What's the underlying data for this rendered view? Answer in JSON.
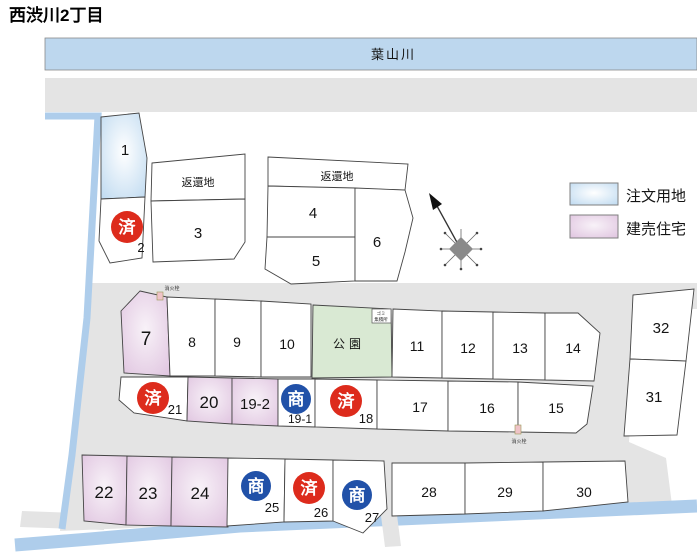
{
  "title": "西渋川2丁目",
  "river": {
    "label": "葉山川"
  },
  "legend": {
    "order_land": {
      "label": "注文用地",
      "fill": "#BDD9F0"
    },
    "built_house": {
      "label": "建売住宅",
      "fill": "#DFC3DF"
    }
  },
  "annotations": {
    "returned_land": "返還地",
    "park": "公園",
    "fire_hydrant": "消火栓",
    "garbage_line1": "ゴミ",
    "garbage_line2": "集積所"
  },
  "badges": {
    "sold": "済",
    "dealing": "商"
  },
  "colors": {
    "sold_badge": "#DD2B1C",
    "dealing_badge": "#2151A8",
    "water": "#AECDEB",
    "river_fill": "#BDD7EE",
    "road": "#E4E4E4",
    "park_fill": "#D9E9D3"
  },
  "lots": {
    "l1": {
      "number": "1",
      "type": "order_land"
    },
    "l2": {
      "number": "2",
      "badge": "済"
    },
    "l3": {
      "number": "3"
    },
    "l4": {
      "number": "4"
    },
    "l5": {
      "number": "5"
    },
    "l6": {
      "number": "6"
    },
    "l7": {
      "number": "7",
      "type": "built_house"
    },
    "l8": {
      "number": "8"
    },
    "l9": {
      "number": "9"
    },
    "l10": {
      "number": "10"
    },
    "l11": {
      "number": "11"
    },
    "l12": {
      "number": "12"
    },
    "l13": {
      "number": "13"
    },
    "l14": {
      "number": "14"
    },
    "l15": {
      "number": "15"
    },
    "l16": {
      "number": "16"
    },
    "l17": {
      "number": "17"
    },
    "l18": {
      "number": "18",
      "badge": "済"
    },
    "l19_1": {
      "number": "19-1",
      "badge": "商"
    },
    "l19_2": {
      "number": "19-2",
      "type": "built_house"
    },
    "l20": {
      "number": "20",
      "type": "built_house"
    },
    "l21": {
      "number": "21",
      "badge": "済"
    },
    "l22": {
      "number": "22",
      "type": "built_house"
    },
    "l23": {
      "number": "23",
      "type": "built_house"
    },
    "l24": {
      "number": "24",
      "type": "built_house"
    },
    "l25": {
      "number": "25",
      "badge": "商"
    },
    "l26": {
      "number": "26",
      "badge": "済"
    },
    "l27": {
      "number": "27",
      "badge": "商"
    },
    "l28": {
      "number": "28"
    },
    "l29": {
      "number": "29"
    },
    "l30": {
      "number": "30"
    },
    "l31": {
      "number": "31"
    },
    "l32": {
      "number": "32"
    }
  }
}
